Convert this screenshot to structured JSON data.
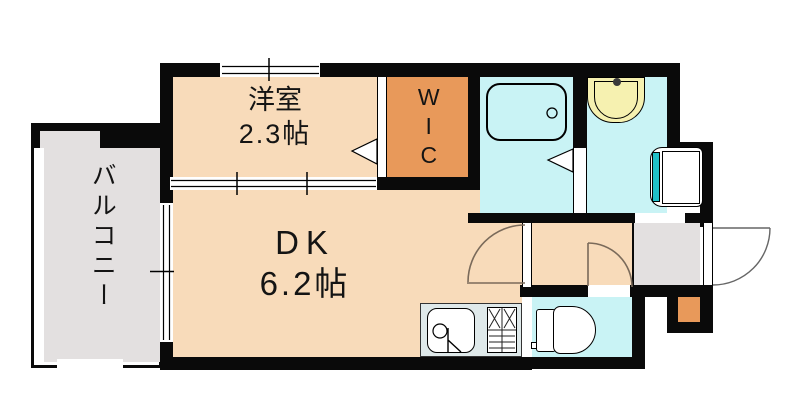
{
  "rooms": {
    "balcony": {
      "label": "バルコニー"
    },
    "western_room": {
      "label": "洋室",
      "size": "2.3帖"
    },
    "wic": {
      "label": "WIC"
    },
    "dining_kitchen": {
      "label": "DK",
      "size": "6.2帖"
    }
  },
  "colors": {
    "wall": "#0a0a0a",
    "room_floor_peach": "#f8dbba",
    "closet_orange": "#e8995a",
    "wet_area_cyan": "#c9f3f5",
    "balcony_gray": "#e3e0e0",
    "entrance_gray": "#e3e0e0",
    "washbasin_yellow": "#f6f1b0",
    "appliance_teal": "#20c0c8",
    "kitchen_counter_gray": "#dfe9ea"
  }
}
